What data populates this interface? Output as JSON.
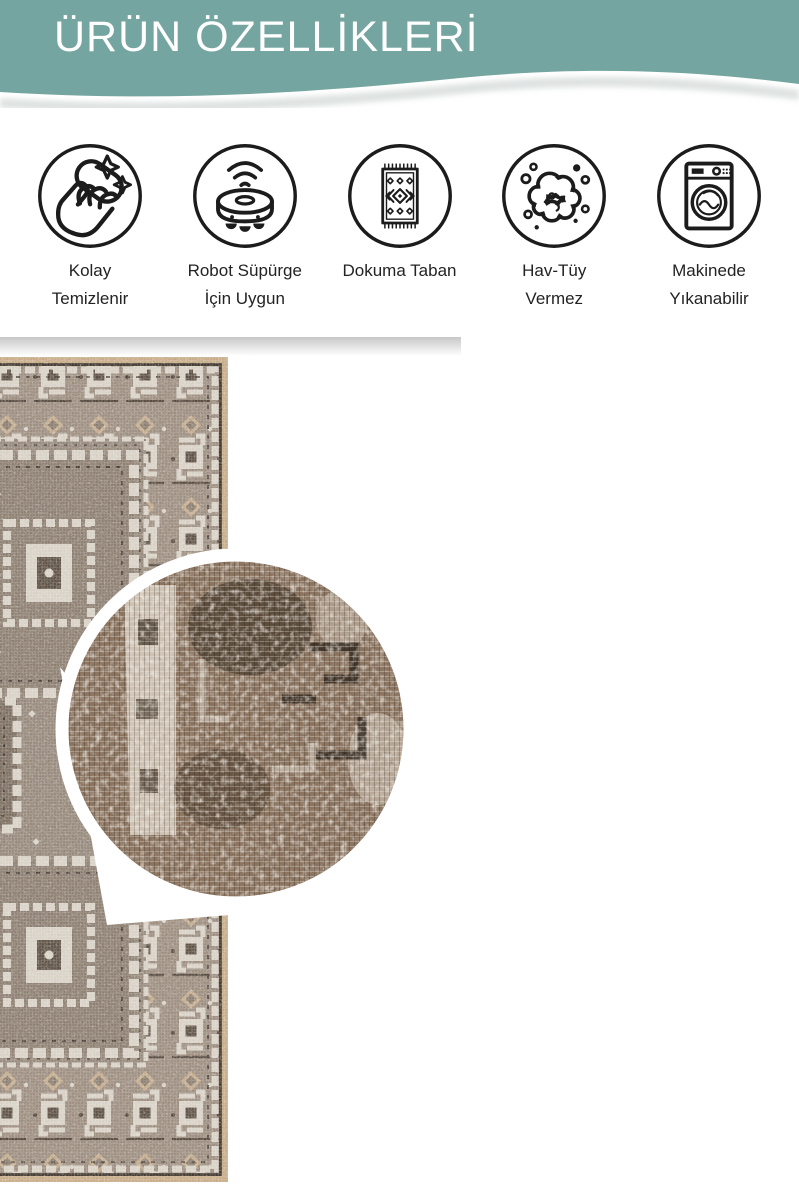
{
  "header": {
    "title": "ÜRÜN ÖZELLİKLERİ"
  },
  "theme": {
    "teal": "#74a5a0",
    "title": "#ffffff",
    "label": "#232323",
    "icon": "#1c1c1c"
  },
  "features": {
    "items": [
      {
        "icon": "hand-wipe-icon",
        "line1": "Kolay",
        "line2": "Temizlenir"
      },
      {
        "icon": "robot-vacuum-icon",
        "line1": "Robot Süpürge",
        "line2": "İçin Uygun"
      },
      {
        "icon": "woven-rug-icon",
        "line1": "Dokuma Taban",
        "line2": ""
      },
      {
        "icon": "lint-cloud-icon",
        "line1": "Hav-Tüy",
        "line2": "Vermez"
      },
      {
        "icon": "washing-machine-icon",
        "line1": "Makinede",
        "line2": "Yıkanabilir"
      }
    ]
  },
  "product_photo": {
    "subject": "vintage geometric rug with circular zoom detail",
    "colors": {
      "edge_tan": "#c7ab87",
      "outline_dark": "#42392f",
      "band_base": "#9c8d7f",
      "motif_cream": "#d8d1c6",
      "motif_tan": "#c3ab8d",
      "field": "#95887a",
      "panel": "#8c7e70",
      "panel_core": "#5d5044",
      "zoom_base": "#8b7460",
      "zoom_dark": "#2a2014",
      "zoom_cream": "#d9d0c3"
    }
  }
}
